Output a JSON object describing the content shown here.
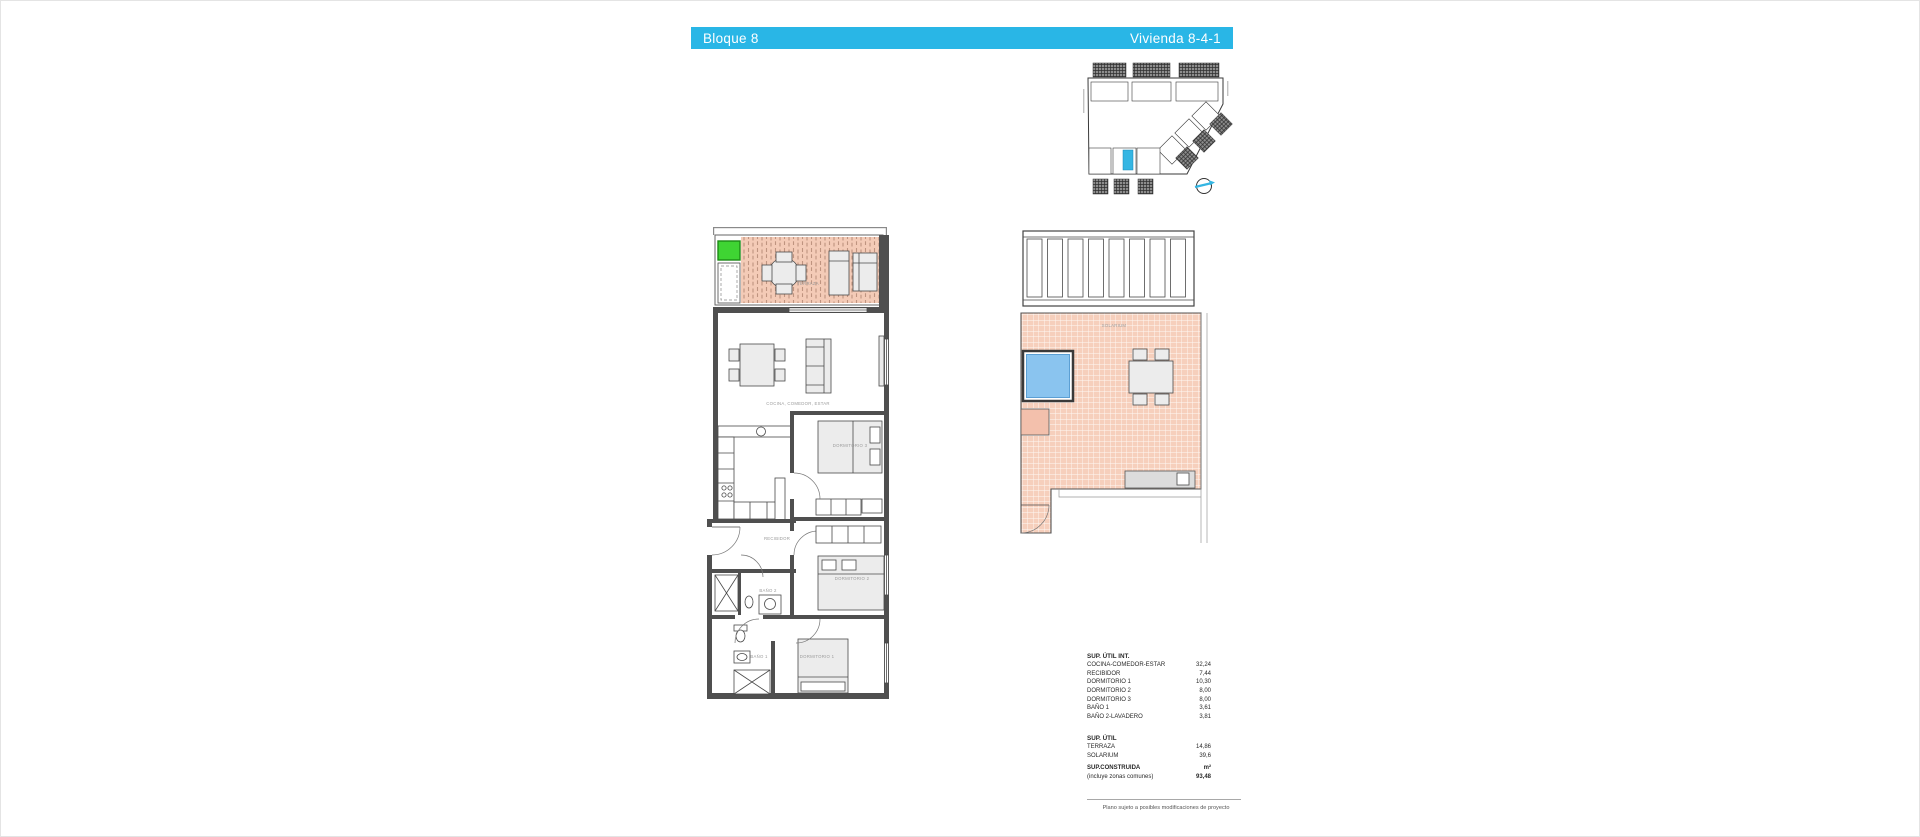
{
  "header": {
    "block": "Bloque 8",
    "unit": "Vivienda  8-4-1"
  },
  "floor_plan": {
    "terraza": "TERRAZA",
    "cocina": "COCINA, COMEDOR, ESTAR",
    "dorm3": "DORMITORIO 3",
    "recibidor": "RECIBIDOR",
    "dorm2": "DORMITORIO 2",
    "bano2": "BAÑO 2",
    "bano1": "BAÑO 1",
    "dorm1": "DORMITORIO 1"
  },
  "solarium_plan": {
    "label": "SOLARIUM"
  },
  "areas": {
    "util_int": {
      "title": "SUP. ÚTIL INT.",
      "rows": [
        {
          "label": "COCINA-COMEDOR-ESTAR",
          "value": "32,24"
        },
        {
          "label": "RECIBIDOR",
          "value": "7,44"
        },
        {
          "label": "DORMITORIO 1",
          "value": "10,30"
        },
        {
          "label": "DORMITORIO 2",
          "value": "8,00"
        },
        {
          "label": "DORMITORIO 3",
          "value": "8,00"
        },
        {
          "label": "BAÑO 1",
          "value": "3,61"
        },
        {
          "label": "BAÑO 2-LAVADERO",
          "value": "3,81"
        }
      ]
    },
    "util": {
      "title": "SUP. ÚTIL",
      "rows": [
        {
          "label": "TERRAZA",
          "value": "14,86"
        },
        {
          "label": "SOLARIUM",
          "value": "39,6"
        }
      ]
    },
    "construida": {
      "title": "SUP.CONSTRUIDA",
      "unit": "m²",
      "note": "(incluye zonas comunes)",
      "value": "93,48"
    }
  },
  "footer": {
    "note": "Plano sujeto a posibles modificaciones de proyecto"
  },
  "colors": {
    "header_cyan": "#29b6e6",
    "highlight_cyan": "#35b6e3",
    "tile_salmon": "#f6cfbc",
    "pool_blue": "#8ac4ef",
    "green_marker": "#3fd433"
  }
}
